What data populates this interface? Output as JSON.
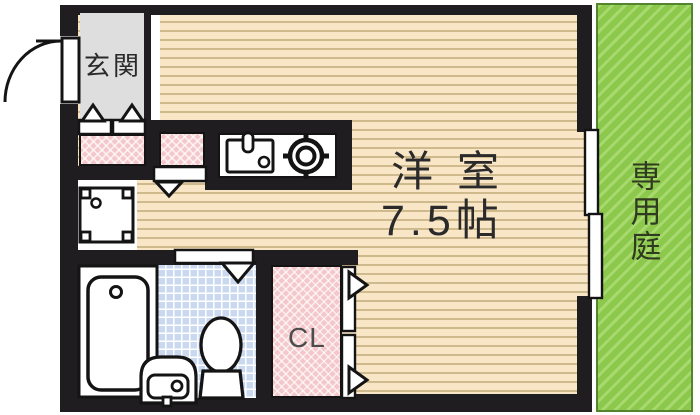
{
  "plan": {
    "title": "apartment-floor-plan",
    "rooms": {
      "entrance": {
        "label": "玄関"
      },
      "main_room": {
        "name": "洋室",
        "size": "7.5帖"
      },
      "garden": {
        "label": "専用庭"
      },
      "closet": {
        "label": "CL"
      }
    },
    "fixtures": [
      "entry-door",
      "step-up-arrows",
      "shoe-cabinet",
      "storage-cabinet",
      "kitchen-sink",
      "gas-stove-burner",
      "washing-machine-pan",
      "bathtub",
      "washbasin",
      "toilet",
      "bathroom-door",
      "room-entry-arrow",
      "sliding-window",
      "closet-folding-doors"
    ],
    "colors": {
      "wall": "#201d20",
      "floor_base": "#f8e6c6",
      "floor_stripe": "#cfba8e",
      "entrance_floor": "#dedede",
      "cabinet_pink": "#f4c8cb",
      "tile_blue": "#cad9f0",
      "garden_green": "#8cc84b",
      "garden_stripe": "#a8d96e",
      "garden_border": "#55842e"
    }
  }
}
